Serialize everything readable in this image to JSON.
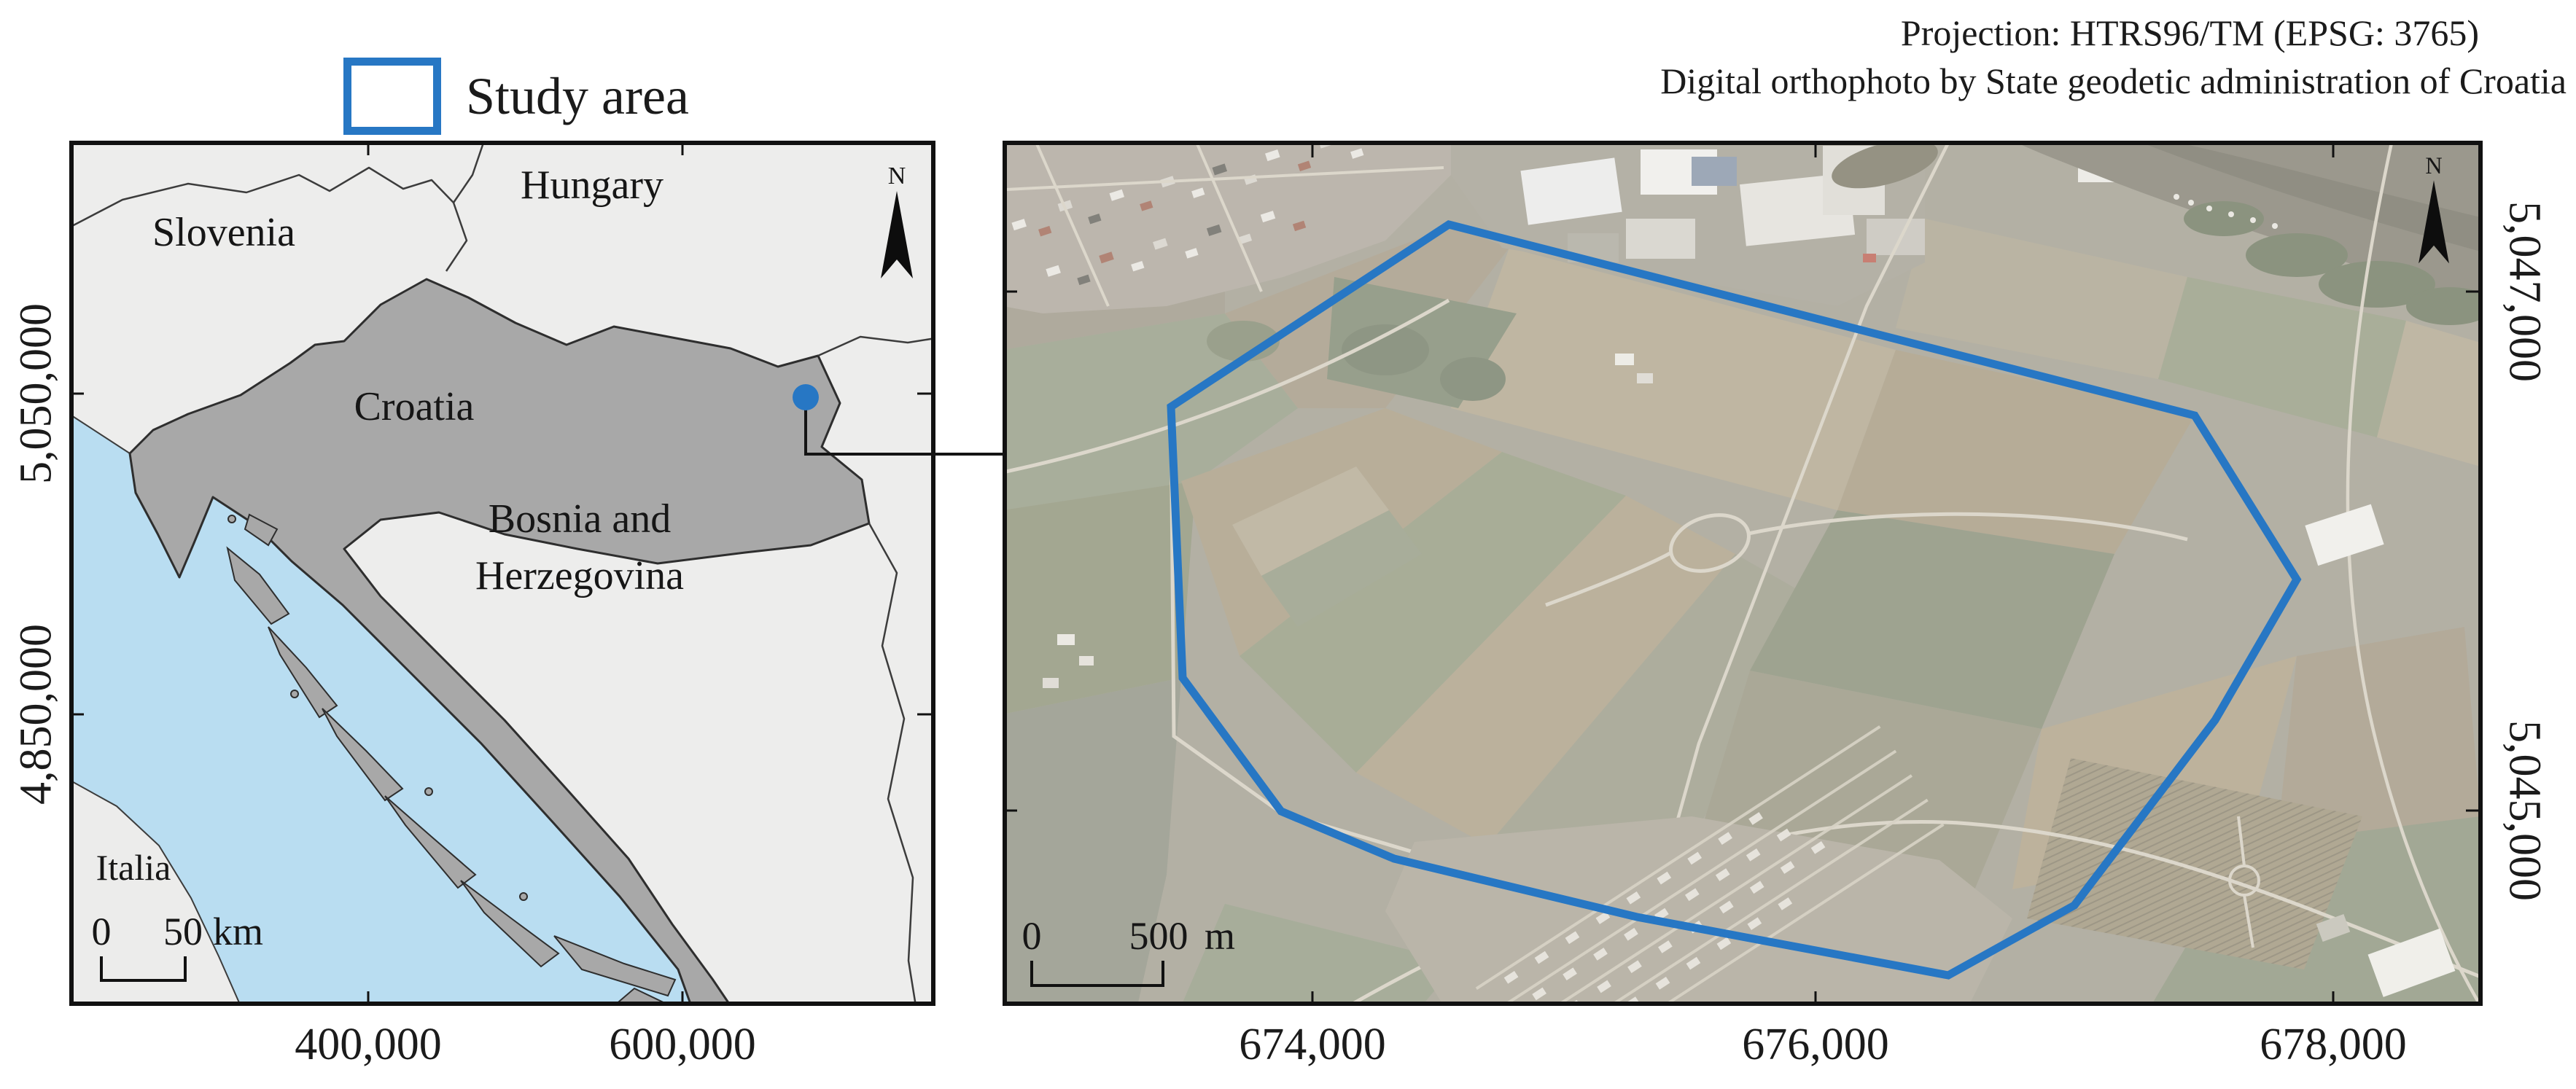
{
  "colors": {
    "accent": "#2777c4"
  },
  "legend": {
    "label": "Study area"
  },
  "credits": {
    "line1": "Projection: HTRS96/TM (EPSG: 3765)",
    "line2": "Digital orthophoto by State geodetic administration of Croatia"
  },
  "overview": {
    "labels": {
      "slovenia": "Slovenia",
      "hungary": "Hungary",
      "croatia": "Croatia",
      "bosnia1": "Bosnia and",
      "bosnia2": "Herzegovina",
      "italia": "Italia"
    },
    "x_ticks": [
      "400,000",
      "600,000"
    ],
    "y_ticks": [
      "5,050,000",
      "4,850,000"
    ],
    "scalebar": {
      "zero": "0",
      "value": "50",
      "unit": "km"
    },
    "north": "N"
  },
  "ortho": {
    "x_ticks": [
      "674,000",
      "676,000",
      "678,000"
    ],
    "y_ticks": [
      "5,047,000",
      "5,045,000"
    ],
    "scalebar": {
      "zero": "0",
      "value": "500",
      "unit": "m"
    },
    "north": "N"
  }
}
